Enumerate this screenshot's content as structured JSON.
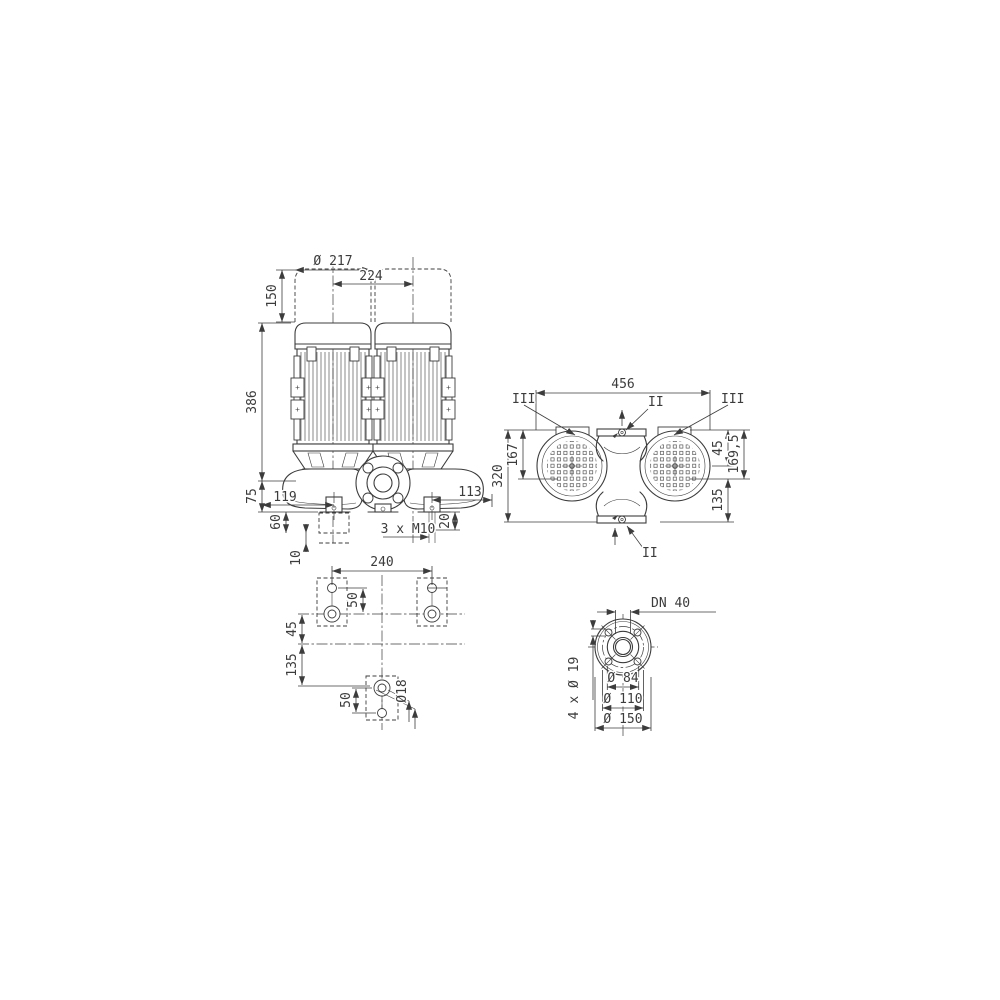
{
  "drawing": {
    "type": "pump-dimensional-drawing",
    "line_color": "#3c3c3c",
    "background": "#ffffff"
  },
  "views": {
    "front": {
      "dims": {
        "motor_diameter": "Ø 217",
        "motor_spacing": "224",
        "dismantling_space": "150",
        "axis_to_motor_top": "386",
        "axis_to_base": "75",
        "foot_offset_left": "119",
        "foot_offset_right": "113",
        "base_to_pad_bottom": "60",
        "pad_step": "10",
        "thread_depth": "20",
        "foot_thread": "3 x M10"
      }
    },
    "top": {
      "dims": {
        "overall_width": "456",
        "overall_depth": "320",
        "face_to_axis": "167",
        "edge_to_axis": "45",
        "edge_to_foot_plane": "169,5",
        "foot_plane_to_back": "135"
      },
      "labels": {
        "section_left": "III",
        "section_right": "III",
        "port_top": "II",
        "port_bottom": "II"
      }
    },
    "footprint": {
      "dims": {
        "bolt_spacing": "240",
        "pair_offset_top": "50",
        "axis_offset": "45",
        "row_offset": "135",
        "pair_offset_bottom": "50",
        "hole_diameter": "Ø18"
      }
    },
    "flange": {
      "dims": {
        "nominal": "DN 40",
        "bolt_holes": "4 x Ø 19",
        "pilot_diameter": "Ø 84",
        "bolt_circle": "Ø 110",
        "outer_diameter": "Ø 150"
      }
    }
  }
}
